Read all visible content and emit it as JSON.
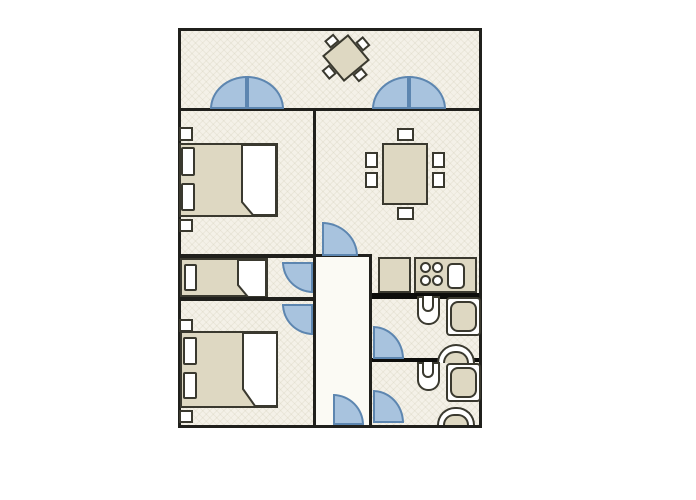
{
  "diagram_type": "apartment-floor-plan",
  "colors": {
    "page_background": "#ffffff",
    "floor": "#f4f1e8",
    "floor_texture_line": "#dcd8c8",
    "corridor_floor": "#fbfaf4",
    "wall": "#20201c",
    "thick_wall": "#0d0d0b",
    "furniture_fill": "#ded8c2",
    "furniture_outline": "#3a392f",
    "fixture_fill": "#ffffff",
    "door_fill": "#a8c3de",
    "door_stroke": "#5d86b0"
  },
  "rooms": [
    {
      "name": "terrace",
      "furniture": [
        "square-table-rotated",
        "chair",
        "chair",
        "chair",
        "chair"
      ],
      "doors": [
        "double-french-door-left",
        "double-french-door-right"
      ]
    },
    {
      "name": "bedroom-top",
      "furniture": [
        "double-bed",
        "pillow",
        "pillow",
        "folded-sheet",
        "nightstand",
        "nightstand"
      ]
    },
    {
      "name": "single-bedroom",
      "furniture": [
        "single-bed",
        "pillow",
        "folded-sheet"
      ],
      "doors": [
        "swing-door"
      ]
    },
    {
      "name": "bedroom-bottom",
      "furniture": [
        "double-bed",
        "pillow",
        "pillow",
        "folded-sheet",
        "nightstand",
        "nightstand"
      ],
      "doors": [
        "swing-door"
      ]
    },
    {
      "name": "dining-room",
      "furniture": [
        "dining-table",
        "chair",
        "chair",
        "chair",
        "chair",
        "chair",
        "chair"
      ],
      "doors": [
        "swing-door"
      ]
    },
    {
      "name": "kitchen",
      "furniture": [
        "counter",
        "stove-four-burners",
        "kitchen-sink"
      ]
    },
    {
      "name": "bathroom-top",
      "furniture": [
        "toilet",
        "shower",
        "washbasin"
      ],
      "doors": [
        "swing-door"
      ]
    },
    {
      "name": "bathroom-bottom",
      "furniture": [
        "toilet",
        "shower",
        "washbasin"
      ],
      "doors": [
        "swing-door"
      ]
    },
    {
      "name": "corridor",
      "doors": [
        "entrance-swing-door"
      ]
    }
  ],
  "door_swing_count": 10,
  "double_door_count": 2
}
